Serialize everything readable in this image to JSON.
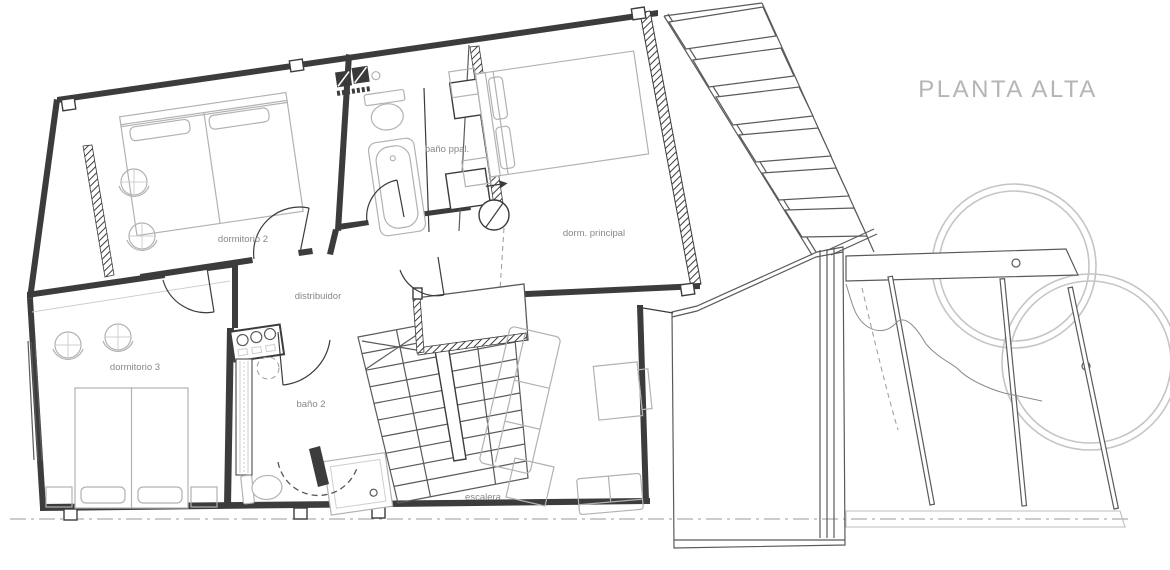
{
  "title": "PLANTA ALTA",
  "rooms": {
    "dormitorio2": "dormitorio 2",
    "bano_principal": "baño ppal.",
    "dormitorio_principal": "dorm. principal",
    "distribuidor": "distribuidor",
    "dormitorio3": "dormitorio 3",
    "bano2": "baño 2",
    "escalera": "escalera"
  },
  "colors": {
    "wall": "#3c3c3c",
    "medium_line": "#5a5a5a",
    "furniture_line": "#b2b2b2",
    "tree_line": "#c5c5c5",
    "datum_line": "#999999",
    "label_text": "#888888",
    "title_text": "#b5b5b5",
    "background": "#ffffff"
  }
}
